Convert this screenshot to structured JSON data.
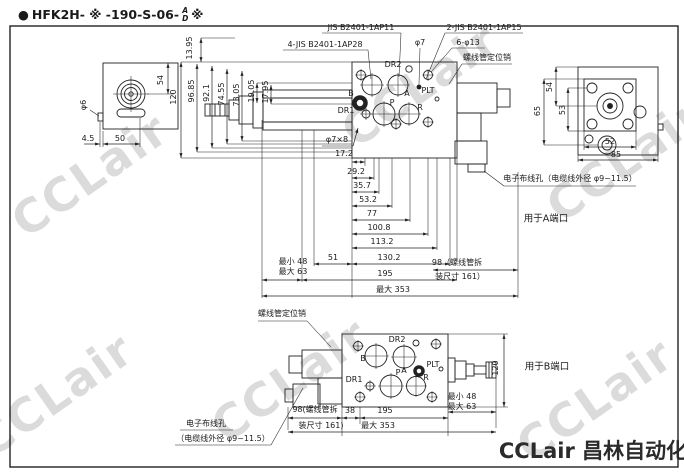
{
  "watermark": {
    "text": "CCLair"
  },
  "title": {
    "bullet": "●",
    "model": "HFK2H- ※ -190-S-06-",
    "stack_top": "A",
    "stack_bottom": "D",
    "suffix": "※"
  },
  "footer": {
    "brand": "CCLair 昌林自动化"
  },
  "colors": {
    "line": "#222222",
    "watermark": "#aaaaaa",
    "paper": "#ffffff"
  },
  "top_view": {
    "callouts": {
      "jis_ap11": "JIS B2401-1AP11",
      "jis_ap15": "2-JIS B2401-1AP15",
      "jis_ap28": "4-JIS B2401-1AP28",
      "phi7": "φ7",
      "six_phi13": "6-φ13",
      "solenoid_pin": "螺线管定位销",
      "phi7x8": "φ7×8",
      "wiring_hole": "电子布线孔（电缆线外径 φ9~11.5）",
      "port_a_note": "用于A端口"
    },
    "left_view_dims": {
      "d54": "54",
      "phi6": "φ6",
      "d45": "4.5",
      "d50": "50"
    },
    "vertical_dims": {
      "d1395": "13.95",
      "d120": "120",
      "d9685": "96.85",
      "d921": "92.1",
      "d7455": "74.55",
      "d7305": "73.05",
      "d1905": "19.05",
      "d1795": "17.95"
    },
    "ports": {
      "dr2": "DR2",
      "b": "B",
      "a": "A",
      "plt": "PLT",
      "dr1": "DR1",
      "p": "P",
      "r": "R"
    },
    "chain_dims": {
      "d172": "17.2",
      "d292": "29.2",
      "d357": "35.7",
      "d532": "53.2",
      "d77": "77",
      "d1008": "100.8",
      "d1132": "113.2",
      "d1302": "130.2",
      "d51": "51",
      "d195": "195",
      "max353": "最大 353",
      "min48": "最小 48",
      "max63": "最大 63",
      "sol98": "98（螺线管拆",
      "sol161": "装尺寸 161）"
    },
    "right_view_dims": {
      "d54": "54",
      "d65": "65",
      "d53": "53",
      "d52": "52",
      "d85": "85"
    }
  },
  "bottom_view": {
    "callouts": {
      "solenoid_pin": "螺线管定位销",
      "wiring_hole_1": "电子布线孔",
      "wiring_hole_2": "（电缆线外径 φ9~11.5）",
      "port_b_note": "用于B端口"
    },
    "ports": {
      "b": "B",
      "dr2": "DR2",
      "a": "A",
      "plt": "PLT",
      "dr1": "DR1",
      "p": "P",
      "r": "R"
    },
    "dims": {
      "d38": "38",
      "d195": "195",
      "max353": "最大 353",
      "d120": "120",
      "min48": "最小 48",
      "max63": "最大 63",
      "sol98": "98(螺线管拆",
      "sol161": "装尺寸 161)"
    }
  }
}
